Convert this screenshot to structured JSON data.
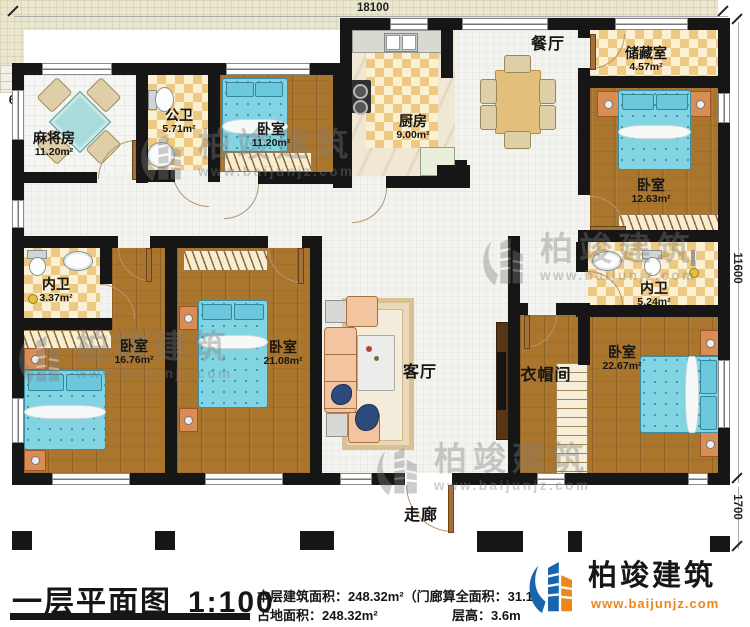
{
  "plan": {
    "rooms": {
      "mahjong": {
        "name": "麻将房",
        "area": "11.20m²"
      },
      "public_bath": {
        "name": "公卫",
        "area": "5.71m²"
      },
      "bedroom1": {
        "name": "卧室",
        "area": "11.20m²"
      },
      "kitchen": {
        "name": "厨房",
        "area": "9.00m²"
      },
      "dining": {
        "name": "餐厅"
      },
      "storage": {
        "name": "储藏室",
        "area": "4.57m²"
      },
      "bedroom2": {
        "name": "卧室",
        "area": "12.63m²"
      },
      "inner_bath1": {
        "name": "内卫",
        "area": "3.37m²"
      },
      "bedroom3": {
        "name": "卧室",
        "area": "16.76m²"
      },
      "bedroom4": {
        "name": "卧室",
        "area": "21.08m²"
      },
      "living": {
        "name": "客厅"
      },
      "living_area_label": "61.70m²",
      "cloakroom": {
        "name": "衣帽间"
      },
      "inner_bath2": {
        "name": "内卫",
        "area": "5.24m²"
      },
      "bedroom5": {
        "name": "卧室",
        "area": "22.67m²"
      },
      "corridor": {
        "name": "走廊"
      }
    },
    "dimensions": {
      "top": "18100",
      "right_upper": "11600",
      "right_lower": "1700"
    }
  },
  "title_block": {
    "title": "一层平面图",
    "scale": "1:100",
    "floor_area_label": "本层建筑面积：248.32m²（门廊算全面积：31.1",
    "ground_area_label": "占地面积：248.32m²",
    "height_label": "层高：3.6m"
  },
  "brand": {
    "name": "柏竣建筑",
    "website": "www.baijunjz.com"
  },
  "watermark": {
    "name": "柏竣建筑",
    "website": "www.baijunjz.com"
  },
  "colors": {
    "wall": "#161616",
    "brand_blue": "#1766ad",
    "brand_orange": "#f08519",
    "bed_blue": "#7ed3e2",
    "wood": "#ad7931",
    "tile_dark": "#efca7e",
    "tile_light": "#fbf0d2"
  }
}
